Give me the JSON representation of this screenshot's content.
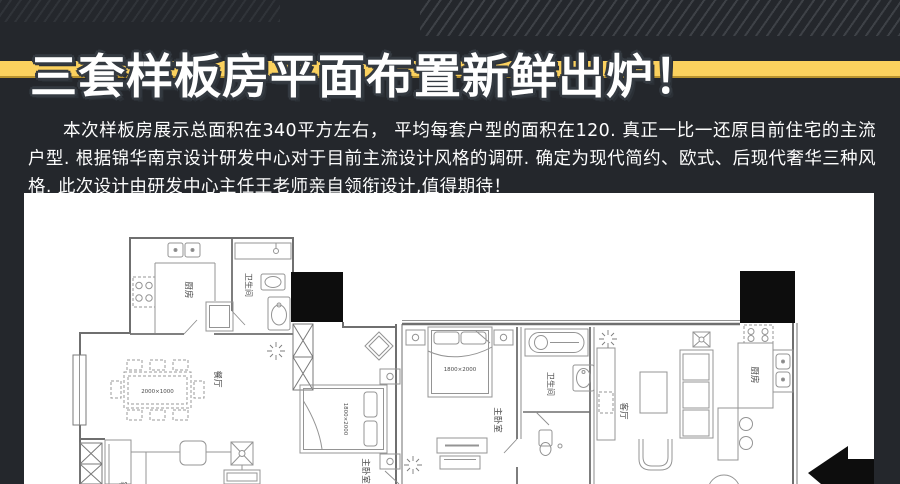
{
  "colors": {
    "background": "#24272c",
    "accent_band": "#fbd15e",
    "panel": "#ffffff",
    "title_fill": "#ffffff",
    "title_outline": "#343a41",
    "column_fill": "#0d0d0d"
  },
  "header": {
    "title": "三套样板房平面布置新鲜出炉！"
  },
  "intro": {
    "text": "本次样板房展示总面积在340平方左右， 平均每套户型的面积在120. 真正一比一还原目前住宅的主流户型. 根据锦华南京设计研发中心对于目前主流设计风格的调研. 确定为现代简约、欧式、后现代奢华三种风格. 此次设计由研发中心主任王老师亲自领衔设计,值得期待！"
  },
  "floorplan": {
    "labels": {
      "kitchen": "厨房",
      "bathroom": "卫生间",
      "dining": "餐厅",
      "living": "客厅",
      "master_bedroom": "主卧室"
    },
    "dims": {
      "table": "2000×1000",
      "bed": "1800×2000"
    },
    "icons": {
      "entrance_arrow": "entrance-direction-arrow",
      "shaft": "elevator-shaft-x",
      "ceiling_fan": "ceiling-fan",
      "lamp": "ceiling-lamp-burst"
    }
  }
}
